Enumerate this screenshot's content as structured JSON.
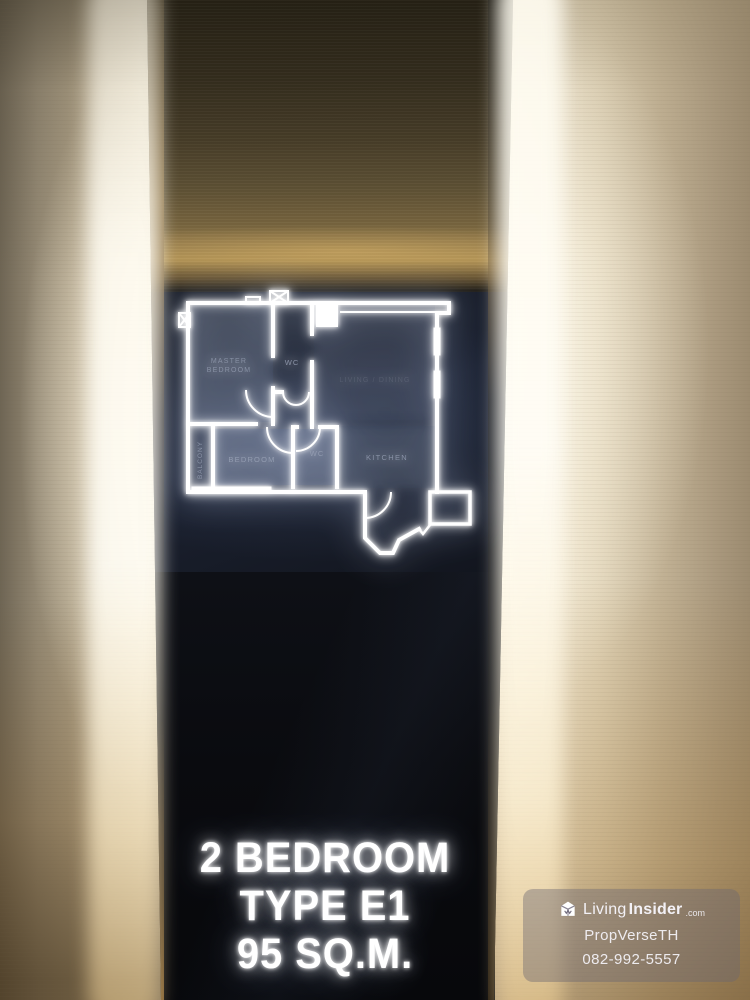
{
  "sign": {
    "line1": "2 BEDROOM",
    "line2": "TYPE E1",
    "line3": "95 SQ.M."
  },
  "floorplan": {
    "labels": {
      "master_line1": "MASTER",
      "master_line2": "BEDROOM",
      "wc_top": "WC",
      "living": "LIVING / DINING",
      "balcony": "BALCONY",
      "bedroom": "BEDROOM",
      "wc_bottom": "WC",
      "kitchen": "KITCHEN"
    }
  },
  "watermark": {
    "brand_light": "Living",
    "brand_bold": "Insider",
    "brand_tld": ".com",
    "line2": "PropVerseTH",
    "line3": "082-992-5557"
  },
  "colors": {
    "glow_white": "#ffffff",
    "panel_bronze": "#8a7147",
    "wall_cream": "#f2e9d4",
    "wall_amber": "#9a7a4a",
    "plan_label": "#98a1b5",
    "panel_dark": "#0b0d11"
  }
}
